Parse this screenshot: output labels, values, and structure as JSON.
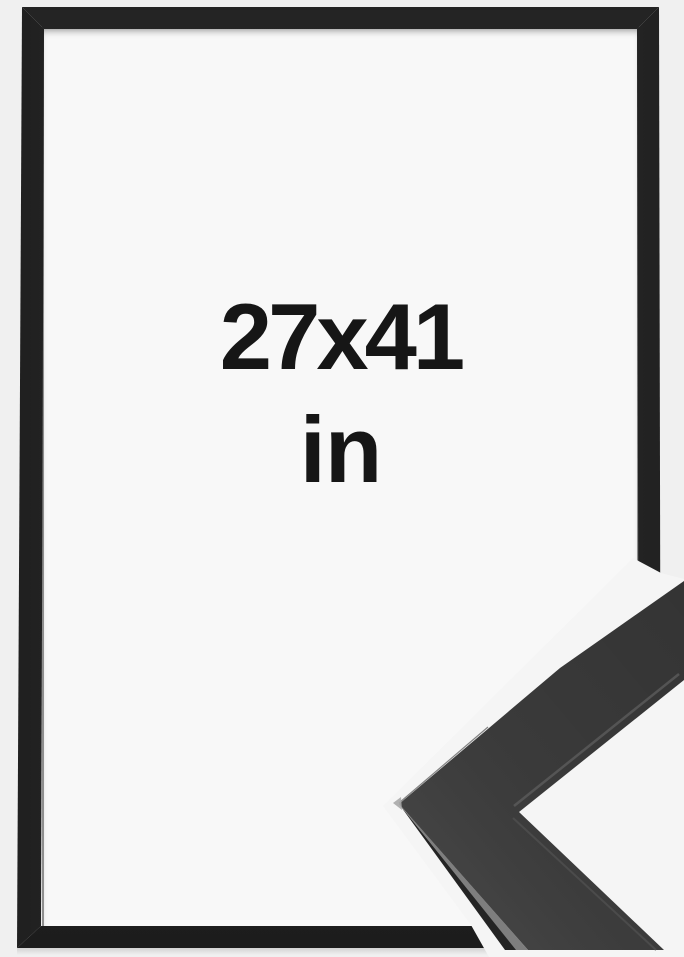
{
  "product_photo": {
    "size_label": {
      "line1": "27x41",
      "line2": "in",
      "full": "27x41 in"
    },
    "frame_color_name": "black"
  },
  "colors": {
    "page_background": "#f0f0f0",
    "mat_background": "#f8f8f8",
    "detail_background": "#f5f5f5",
    "frame_dark_edge": "#1e1e1e",
    "frame_face": "#323232",
    "inner_lip_highlight": "#8f8f8f",
    "label_text": "#161616",
    "moulding_face": "#3a3a3a",
    "moulding_side": "#242424",
    "moulding_bevel": "#7e7e7e",
    "moulding_seam": "#5a5a5a",
    "moulding_seam_lower": "#4f4f4f",
    "moulding_top_rim": "#666666",
    "moulding_tip_highlight": "#a8a8a8"
  }
}
